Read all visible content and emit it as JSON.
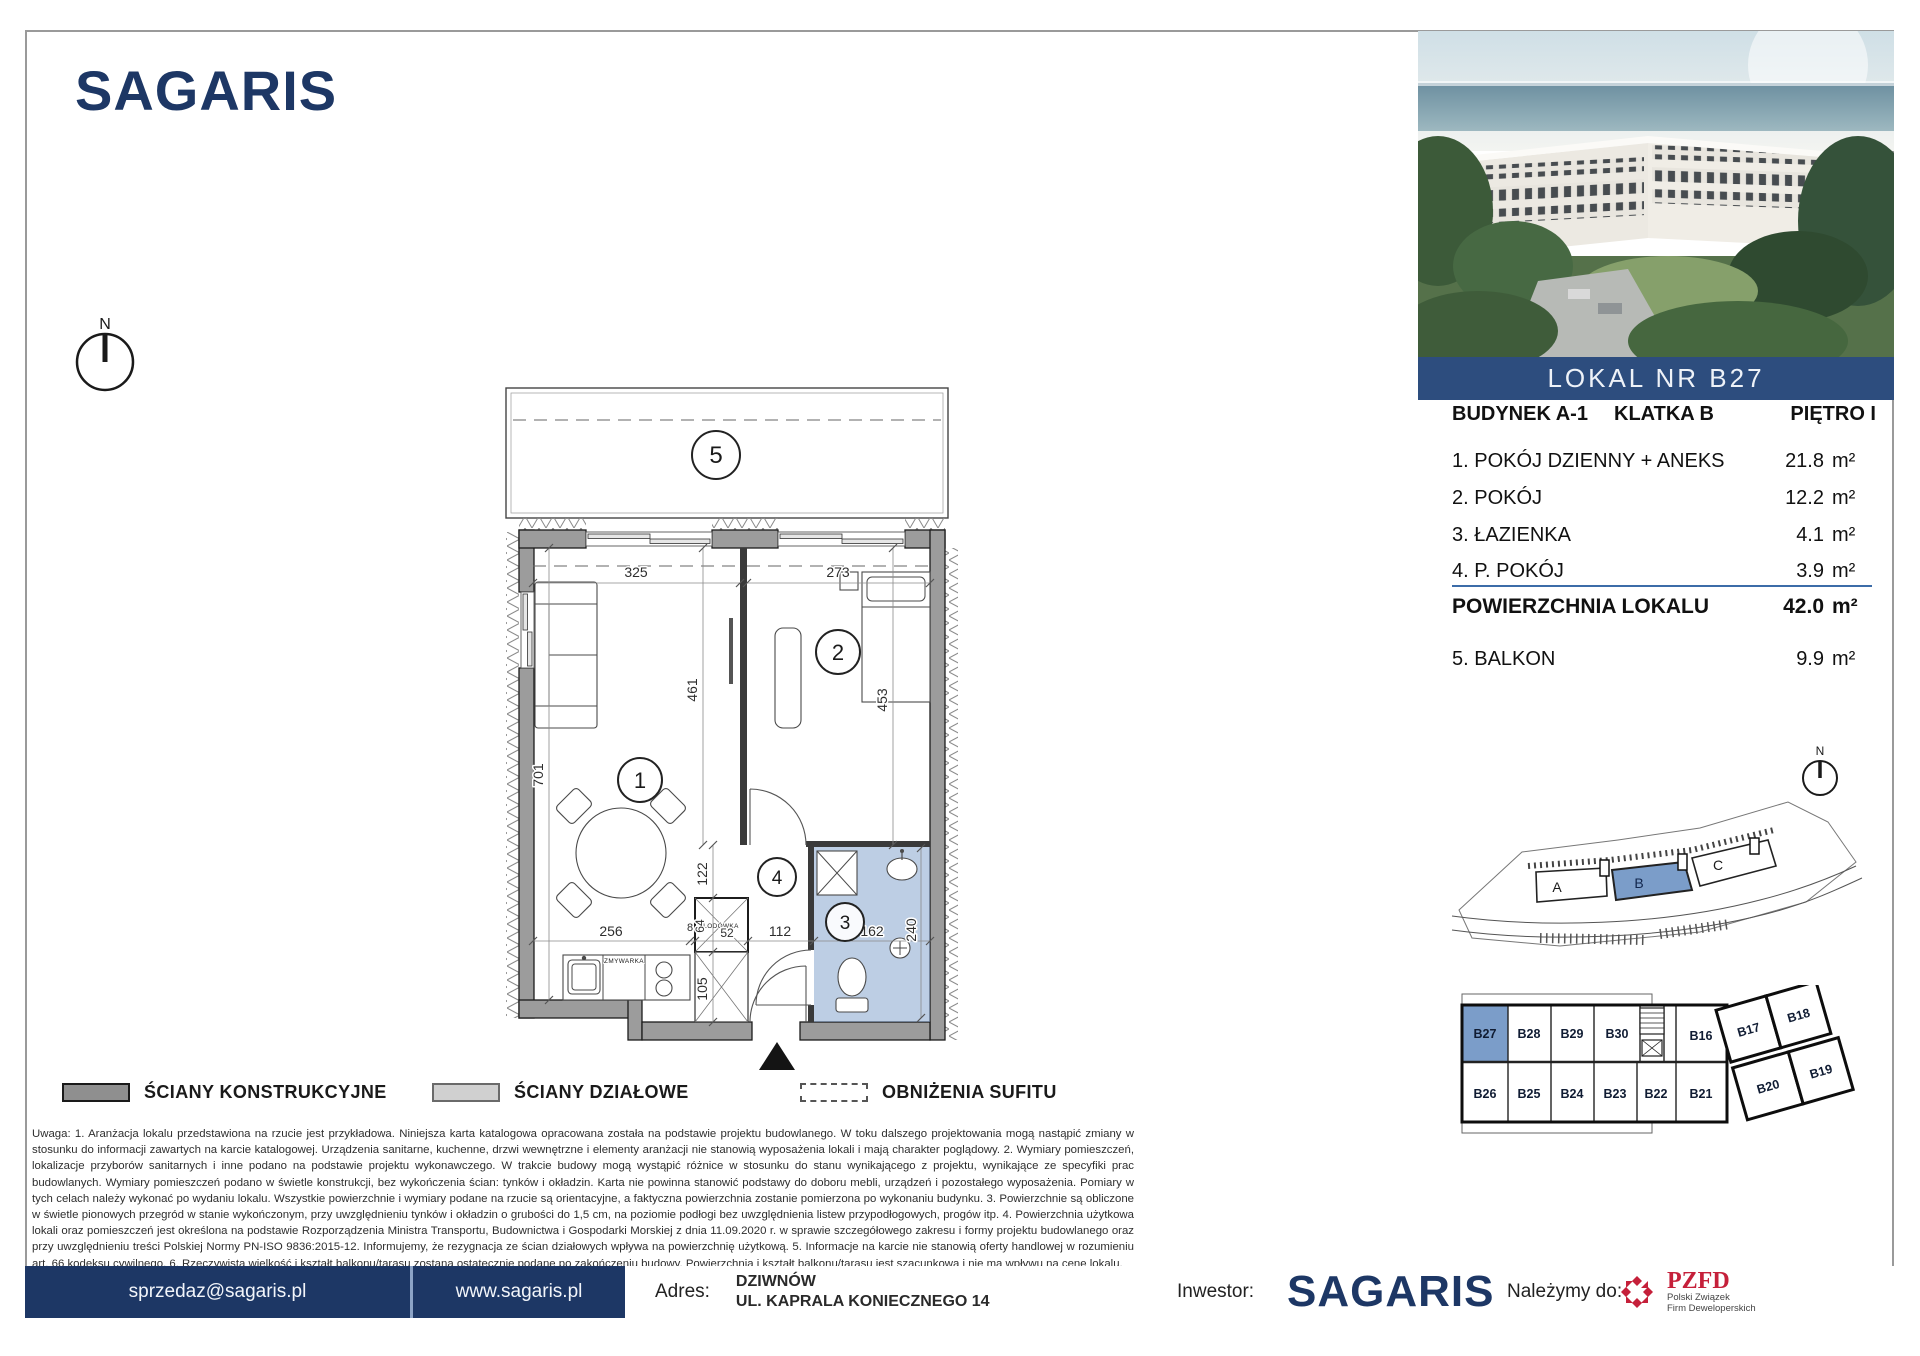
{
  "colors": {
    "navy": "#1d3765",
    "band_blue": "#2d4d7e",
    "highlight_blue": "#7b9dc9",
    "pzfd_red": "#c5203a"
  },
  "brand": {
    "wordmark": "SAGARIS"
  },
  "photo_band": {
    "label": "LOKAL NR B27"
  },
  "unit_header": {
    "building": "BUDYNEK A-1",
    "staircase": "KLATKA B",
    "floor": "PIĘTRO I"
  },
  "room_table": {
    "rows": [
      {
        "name": "1. POKÓJ DZIENNY + ANEKS",
        "area": "21.8",
        "unit": "m²"
      },
      {
        "name": "2. POKÓJ",
        "area": "12.2",
        "unit": "m²"
      },
      {
        "name": "3. ŁAZIENKA",
        "area": "4.1",
        "unit": "m²"
      },
      {
        "name": "4. P. POKÓJ",
        "area": "3.9",
        "unit": "m²"
      }
    ],
    "total": {
      "label": "POWIERZCHNIA LOKALU",
      "area": "42.0",
      "unit": "m²"
    },
    "balcony": {
      "name": "5. BALKON",
      "area": "9.9",
      "unit": "m²"
    }
  },
  "compass": {
    "north": "N"
  },
  "site_plan": {
    "labels": {
      "a": "A",
      "b": "B",
      "c": "C"
    }
  },
  "floor_grid": {
    "cells": [
      "B27",
      "B28",
      "B29",
      "B30",
      "B16",
      "B17",
      "B18",
      "B26",
      "B25",
      "B24",
      "B23",
      "B22",
      "B21",
      "B20",
      "B19"
    ]
  },
  "plan": {
    "room_numbers": {
      "r1": "1",
      "r2": "2",
      "r3": "3",
      "r4": "4",
      "r5": "5"
    },
    "dims": {
      "room1_width": "325",
      "room2_width": "273",
      "wall_mid": "461",
      "room2_depth": "453",
      "room1_depth": "701",
      "hall_upper": "122",
      "kitchen_run": "256",
      "gap": "8",
      "fridge_depth": "64",
      "fridge_width": "52",
      "shaft": "105",
      "hall_width": "112",
      "bath_width": "162",
      "bath_depth": "240"
    },
    "fixtures": {
      "fridge": "LODÓWKA",
      "dishwasher": "ZMYWARKA"
    }
  },
  "legend": {
    "items": [
      {
        "label": "ŚCIANY KONSTRUKCYJNE"
      },
      {
        "label": "ŚCIANY DZIAŁOWE"
      },
      {
        "label": "OBNIŻENIA SUFITU"
      }
    ]
  },
  "disclaimer": "Uwaga:    1. Aranżacja lokalu przedstawiona na rzucie jest przykładowa. Niniejsza karta katalogowa opracowana została na podstawie projektu budowlanego. W toku dalszego projektowania mogą nastąpić zmiany w stosunku do informacji zawartych na karcie katalogowej. Urządzenia sanitarne, kuchenne, drzwi wewnętrzne i elementy aranżacji nie stanowią wyposażenia lokali i mają charakter poglądowy.    2. Wymiary pomieszczeń, lokalizacje przyborów sanitarnych i inne podano na podstawie projektu wykonawczego. W trakcie budowy mogą wystąpić różnice w stosunku do stanu wynikającego z projektu, wynikające ze specyfiki prac budowlanych. Wymiary pomieszczeń podano w świetle konstrukcji, bez wykończenia ścian: tynków i okładzin. Karta nie powinna stanowić podstawy do doboru mebli, urządzeń i pozostałego wyposażenia. Pomiary w tych celach należy wykonać po wydaniu lokalu. Wszystkie powierzchnie i wymiary podane na rzucie są orientacyjne, a faktyczna powierzchnia zostanie pomierzona po wykonaniu budynku.    3. Powierzchnie są obliczone w świetle pionowych przegród w stanie wykończonym, przy uwzględnieniu tynków i okładzin o grubości do 1,5 cm, na poziomie podłogi bez uwzględnienia listew przypodłogowych, progów itp.    4. Powierzchnia użytkowa lokali oraz pomieszczeń jest określona na podstawie Rozporządzenia Ministra Transportu, Budownictwa i Gospodarki Morskiej z dnia 11.09.2020 r. w sprawie szczegółowego zakresu i formy projektu budowlanego oraz przy uwzględnieniu treści Polskiej Normy PN-ISO 9836:2015-12. Informujemy, że rezygnacja ze ścian działowych wpływa na powierzchnię użytkową. 5. Informacje na karcie nie stanowią oferty handlowej w rozumieniu art. 66 kodeksu cywilnego.    6. Rzeczywista wielkość i kształt balkonu/tarasu zostaną ostatecznie podane po zakończeniu budowy. Powierzchnia i kształt balkonu/tarasu jest szacunkowa i nie ma wpływu na cenę lokalu.",
  "footer": {
    "email": "sprzedaz@sagaris.pl",
    "website": "www.sagaris.pl",
    "address_label": "Adres:",
    "address_line1": "DZIWNÓW",
    "address_line2": "UL. KAPRALA KONIECZNEGO 14",
    "investor_label": "Inwestor:",
    "investor_name": "SAGARIS",
    "membership_label": "Należymy do:",
    "pzfd_acronym": "PZFD",
    "pzfd_line1": "Polski Związek",
    "pzfd_line2": "Firm Deweloperskich"
  }
}
